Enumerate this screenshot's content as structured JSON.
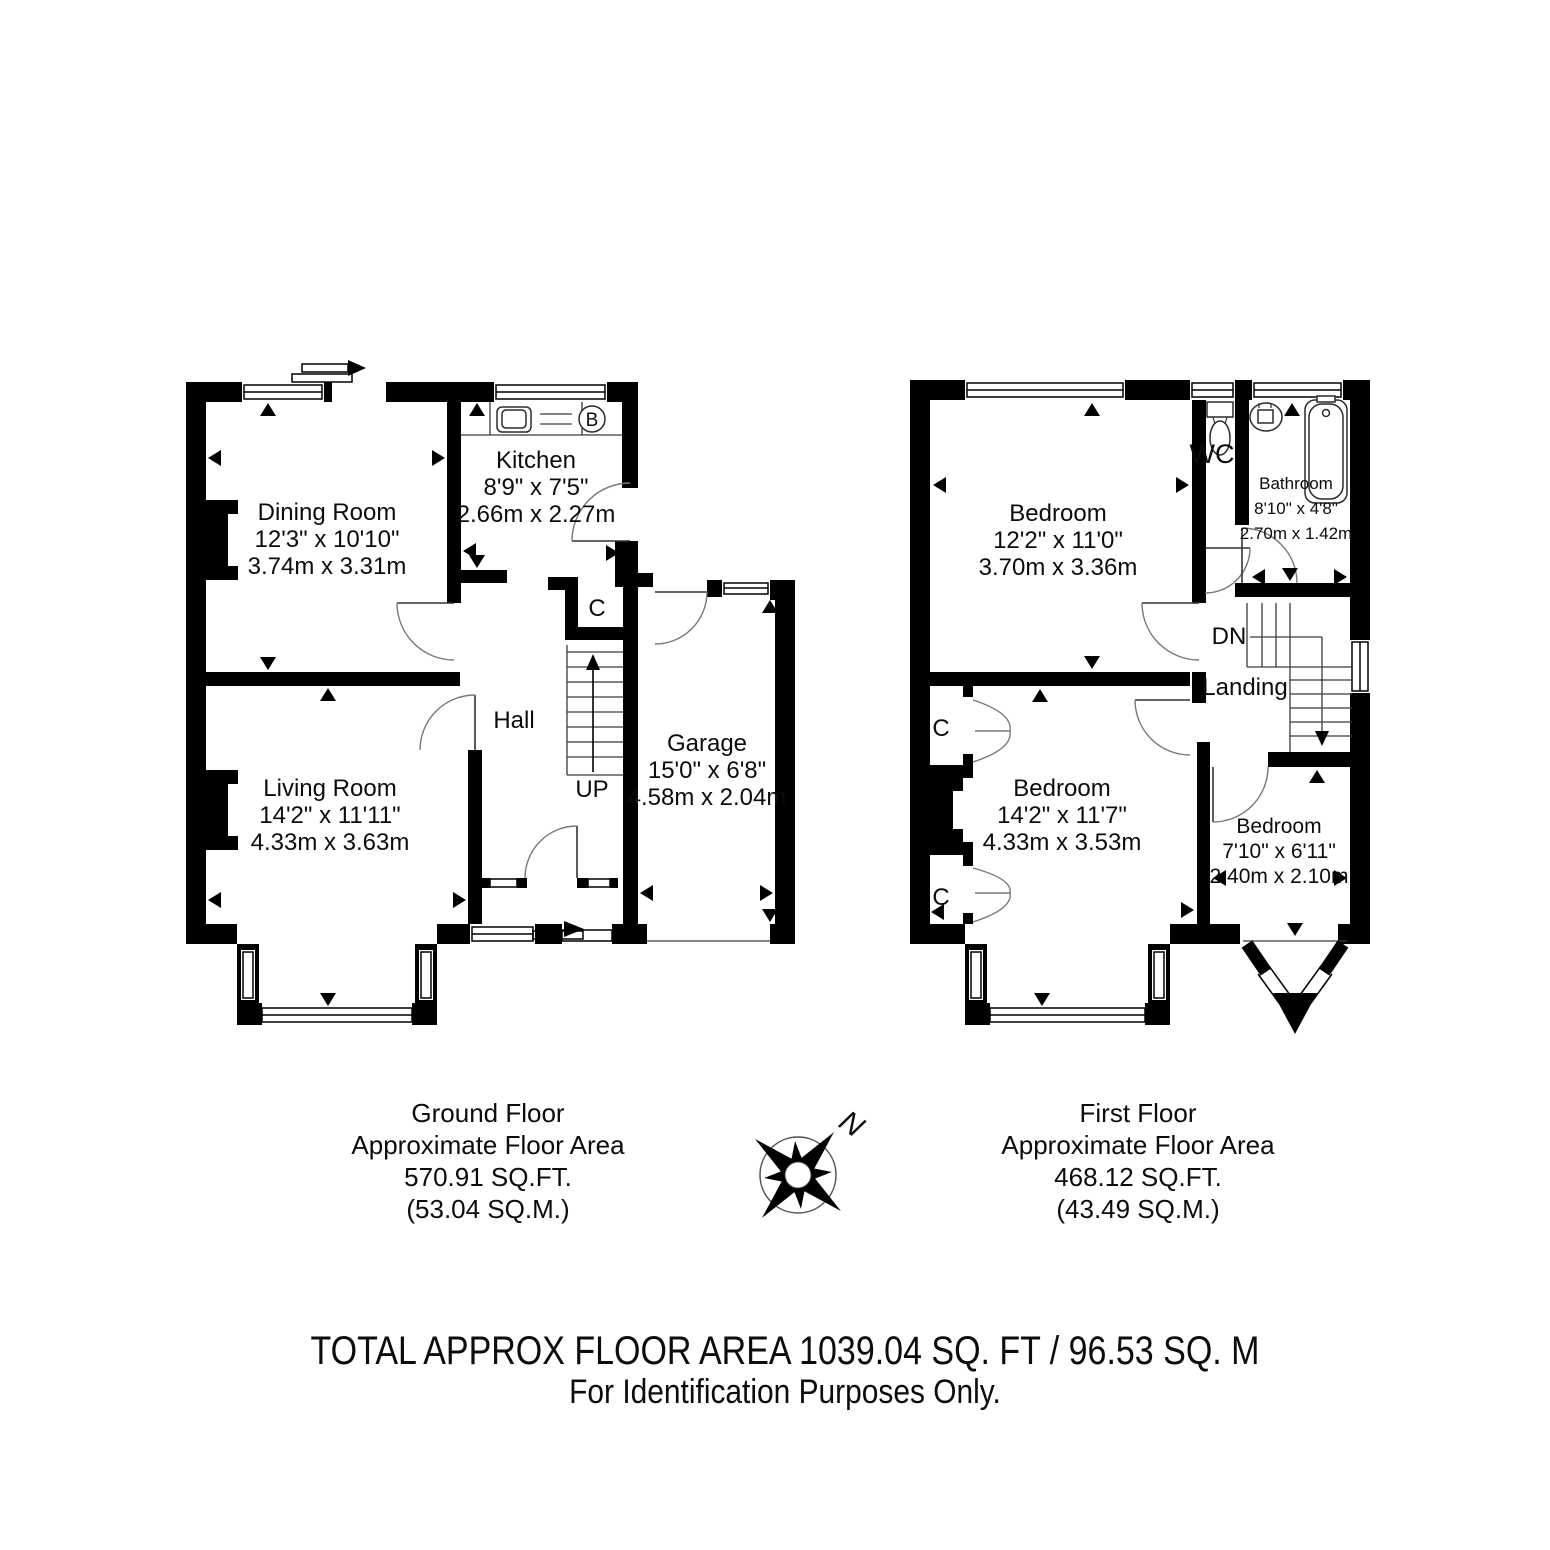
{
  "ground_floor": {
    "rooms": {
      "dining": {
        "name": "Dining Room",
        "imperial": "12'3\" x 10'10\"",
        "metric": "3.74m x 3.31m"
      },
      "kitchen": {
        "name": "Kitchen",
        "imperial": "8'9\" x 7'5\"",
        "metric": "2.66m x 2.27m"
      },
      "living": {
        "name": "Living Room",
        "imperial": "14'2\" x 11'11\"",
        "metric": "4.33m x 3.63m"
      },
      "hall": {
        "name": "Hall"
      },
      "garage": {
        "name": "Garage",
        "imperial": "15'0\" x 6'8\"",
        "metric": "4.58m x 2.04m"
      }
    },
    "labels": {
      "up": "UP",
      "cupboard": "C",
      "boiler": "B"
    },
    "caption": {
      "line1": "Ground Floor",
      "line2": "Approximate Floor Area",
      "line3": "570.91 SQ.FT.",
      "line4": "(53.04 SQ.M.)"
    }
  },
  "first_floor": {
    "rooms": {
      "bedroom1": {
        "name": "Bedroom",
        "imperial": "12'2\" x 11'0\"",
        "metric": "3.70m x 3.36m"
      },
      "wc": {
        "name": "WC"
      },
      "bathroom": {
        "name": "Bathroom",
        "imperial": "8'10\" x 4'8\"",
        "metric": "2.70m x 1.42m"
      },
      "landing": {
        "name": "Landing"
      },
      "bedroom2": {
        "name": "Bedroom",
        "imperial": "14'2\" x 11'7\"",
        "metric": "4.33m x 3.53m"
      },
      "bedroom3": {
        "name": "Bedroom",
        "imperial": "7'10\" x 6'11\"",
        "metric": "2.40m x 2.10m"
      }
    },
    "labels": {
      "down": "DN",
      "cupboard": "C"
    },
    "caption": {
      "line1": "First Floor",
      "line2": "Approximate Floor Area",
      "line3": "468.12 SQ.FT.",
      "line4": "(43.49 SQ.M.)"
    }
  },
  "compass": {
    "north_label": "N"
  },
  "footer": {
    "line1": "TOTAL APPROX FLOOR AREA 1039.04 SQ. FT / 96.53 SQ. M",
    "line2": "For Identification Purposes Only."
  },
  "colors": {
    "walls": "#000000",
    "background": "#ffffff"
  }
}
